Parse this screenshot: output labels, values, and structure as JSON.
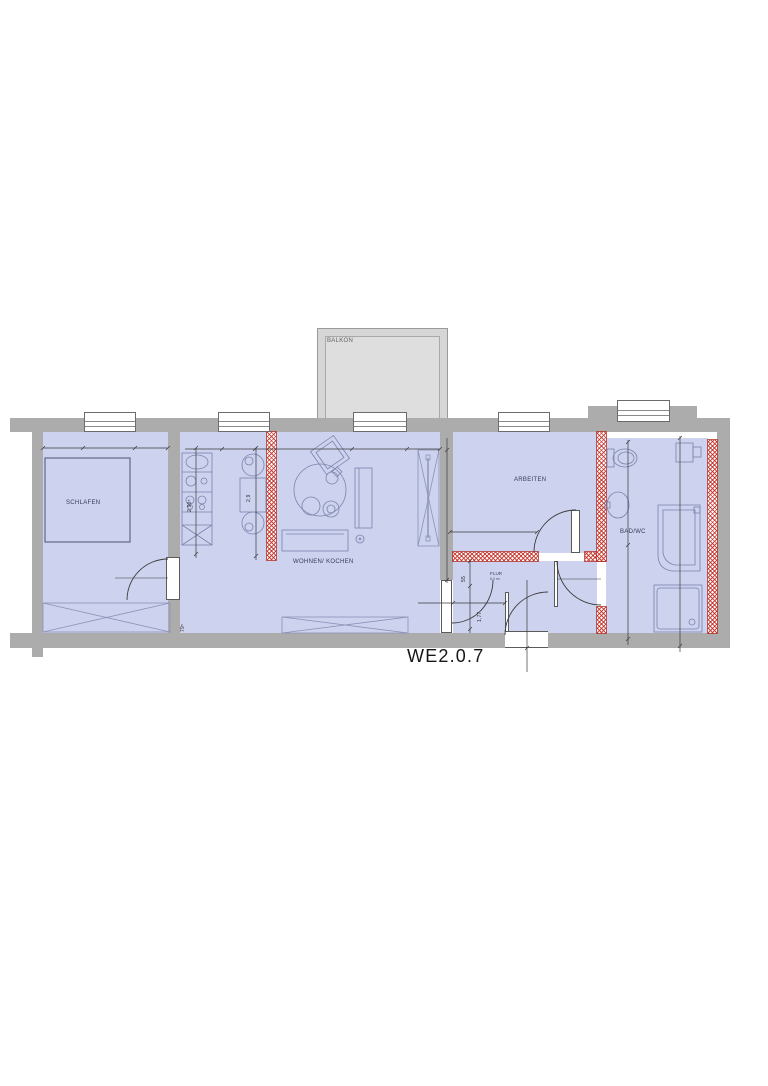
{
  "title": "WE2.0.7",
  "rooms": {
    "balkon": {
      "label": "BALKON"
    },
    "schlafen": {
      "label": "SCHLAFEN"
    },
    "wohnen_kochen": {
      "label": "WOHNEN/ KOCHEN"
    },
    "arbeiten": {
      "label": "ARBEITEN"
    },
    "flur": {
      "label": "FLUR",
      "area": "6,0 m²"
    },
    "bad_wc": {
      "label": "BAD/WC"
    }
  },
  "dimensions": {
    "kitchen_depth": "2.90⁵",
    "dining_width": "2,9",
    "schlafen_bottom": "79⁵",
    "flur_width": "55",
    "flur_length": "1,77"
  },
  "colors": {
    "room_fill": "#cdd2ef",
    "wall_gray": "#acacac",
    "hatch_red": "#c32d23",
    "balcony_fill": "#d6d6d6",
    "furniture_line": "#7b84ab"
  }
}
